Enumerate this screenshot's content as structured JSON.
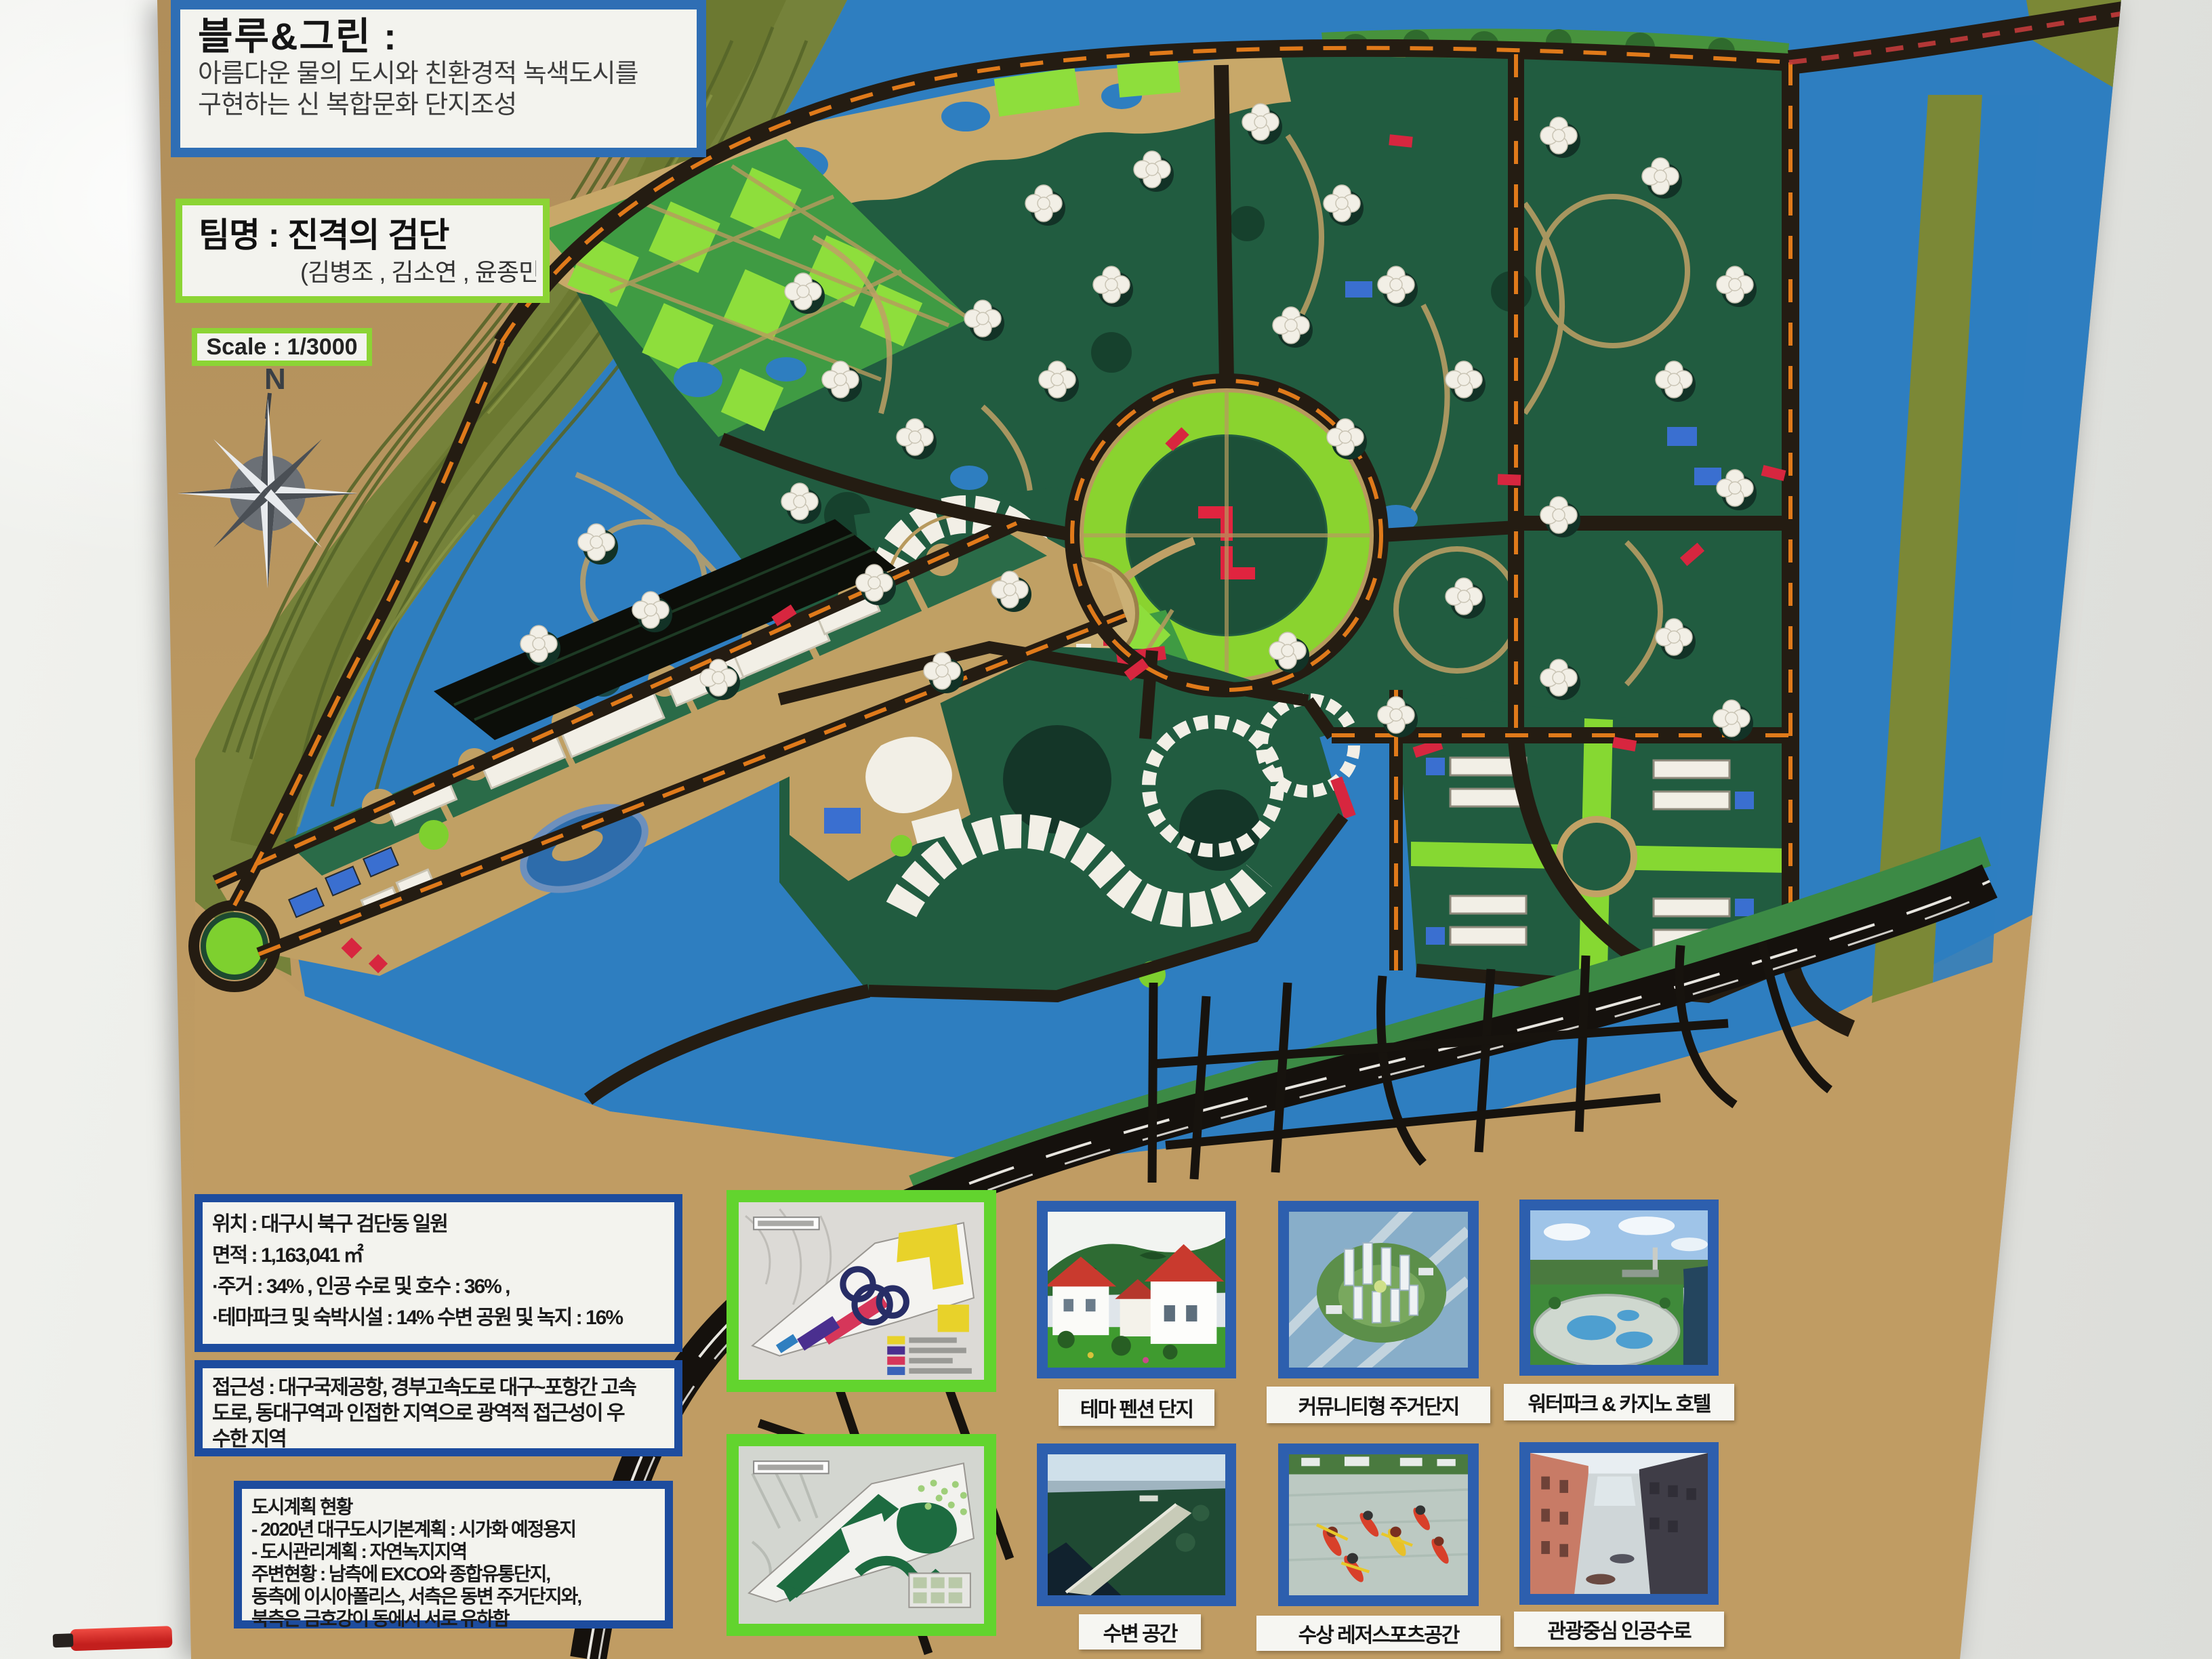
{
  "board": {
    "title_box": {
      "title": "블루&그린 :",
      "line1": "아름다운 물의 도시와 친환경적 녹색도시를",
      "line2": "구현하는 신 복합문화 단지조성"
    },
    "team_box": {
      "team": "팀명 : 진격의 검단",
      "members": "(김병조 , 김소연 , 윤종민)"
    },
    "scale_box": {
      "label": "Scale : 1/3000"
    },
    "compass": {
      "north_label": "N"
    },
    "info_boxes": [
      {
        "id": "location",
        "lines": [
          "위치 : 대구시 북구 검단동 일원",
          "면적 : 1,163,041 ㎡",
          "·주거 : 34% , 인공 수로 및 호수 : 36% ,",
          "·테마파크 및 숙박시설 : 14% 수변 공원 및 녹지 : 16%"
        ]
      },
      {
        "id": "access",
        "lines": [
          "접근성 : 대구국제공항, 경부고속도로 대구~포항간 고속",
          "도로, 동대구역과 인접한 지역으로 광역적 접근성이 우",
          "수한 지역"
        ]
      },
      {
        "id": "urban-plan",
        "lines": [
          "도시계획 현황",
          "- 2020년 대구도시기본계획 : 시가화 예정용지",
          "- 도시관리계획 : 자연녹지지역",
          "주변현황 : 남측에 EXCO와 종합유통단지,",
          "동측에 이시아폴리스, 서측은 동변 주거단지와,",
          "북측은 금호강이 동에서 서로 유하함"
        ]
      }
    ],
    "photo_captions_row1": [
      "테마 펜션 단지",
      "커뮤니티형 주거단지",
      "워터파크 & 카지노 호텔"
    ],
    "photo_captions_row2": [
      "수변 공간",
      "수상 레저스포츠공간",
      "관광중심 인공수로"
    ]
  },
  "map_model": {
    "building_clusters": [
      [
        880,
        800
      ],
      [
        960,
        900
      ],
      [
        1060,
        1000
      ],
      [
        795,
        950
      ],
      [
        1180,
        740
      ],
      [
        1290,
        860
      ],
      [
        1390,
        990
      ],
      [
        1490,
        870
      ],
      [
        1240,
        560
      ],
      [
        1350,
        645
      ],
      [
        1450,
        470
      ],
      [
        1185,
        430
      ],
      [
        1560,
        560
      ],
      [
        1640,
        420
      ],
      [
        1540,
        300
      ],
      [
        1700,
        250
      ],
      [
        1860,
        180
      ],
      [
        1980,
        300
      ],
      [
        1905,
        480
      ],
      [
        2060,
        420
      ],
      [
        2160,
        560
      ],
      [
        1985,
        645
      ],
      [
        2300,
        200
      ],
      [
        2450,
        260
      ],
      [
        2560,
        420
      ],
      [
        2470,
        560
      ],
      [
        2560,
        720
      ],
      [
        2300,
        760
      ],
      [
        2160,
        880
      ],
      [
        2300,
        1000
      ],
      [
        2470,
        940
      ],
      [
        2555,
        1060
      ],
      [
        1900,
        960
      ],
      [
        2060,
        1055
      ]
    ],
    "red_accents": [
      [
        1720,
        640
      ],
      [
        2210,
        700
      ],
      [
        2480,
        810
      ],
      [
        2050,
        200
      ],
      [
        1660,
        980
      ],
      [
        2380,
        1090
      ],
      [
        1140,
        900
      ],
      [
        2600,
        690
      ]
    ]
  },
  "palette": {
    "board_tan": "#bd9a62",
    "water_blue": "#2e7ec0",
    "mountain_olive": "#75823a",
    "site_green": "#215c40",
    "bright_green": "#7ed02f",
    "road_dark": "#241c12",
    "road_dash_orange": "#e07a1a",
    "accent_red": "#d7263f",
    "building_white": "#f2efe6",
    "border_blue": "#2f6eb4",
    "border_navy": "#1d4c9e",
    "border_green": "#8cd435",
    "magenta": "#df2a7d",
    "expressway_black": "#15110d"
  }
}
